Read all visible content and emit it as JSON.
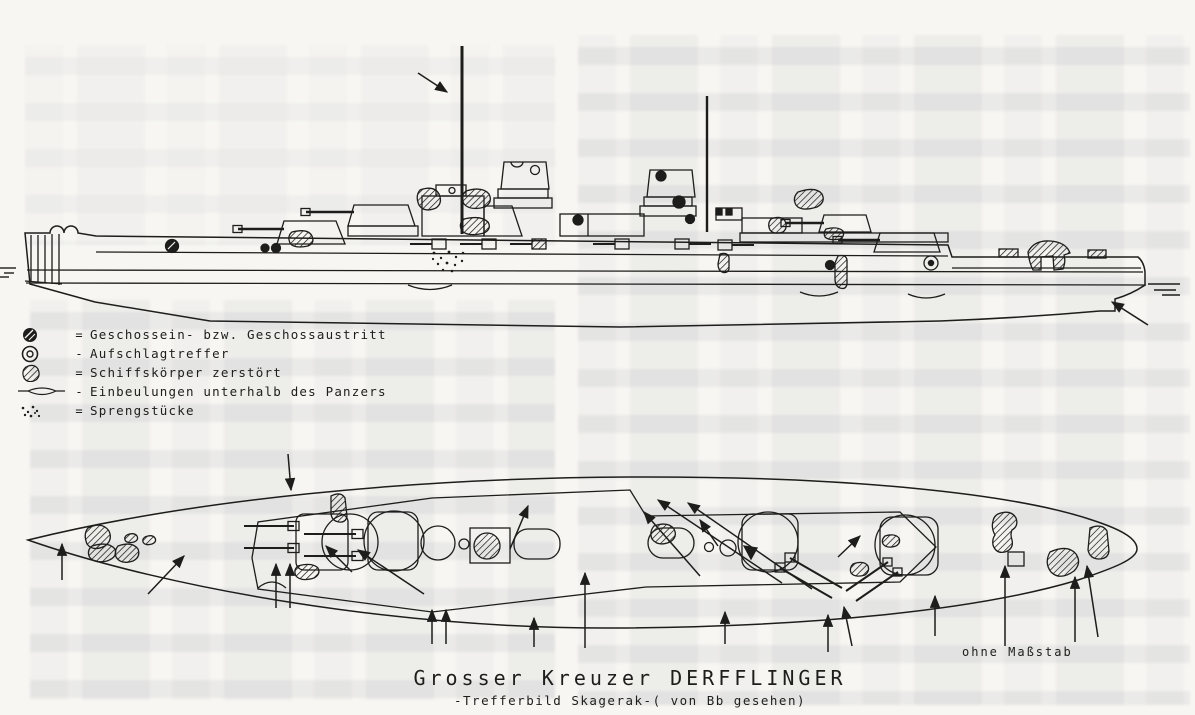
{
  "colors": {
    "ink": "#1d1d1b",
    "paper": "#f7f6f2"
  },
  "legend": {
    "items": [
      {
        "icon": "shell-entry-exit-symbol",
        "sep": "=",
        "label": "Geschossein- bzw. Geschossaustritt"
      },
      {
        "icon": "impact-hit-symbol",
        "sep": "-",
        "label": "Aufschlagtreffer"
      },
      {
        "icon": "hull-destroyed-symbol",
        "sep": "=",
        "label": "Schiffskörper zerstört"
      },
      {
        "icon": "dent-below-armor-symbol",
        "sep": "-",
        "label": "Einbeulungen unterhalb des Panzers"
      },
      {
        "icon": "shell-fragments-symbol",
        "sep": "=",
        "label": "Sprengstücke"
      }
    ]
  },
  "caption": {
    "title": "Grosser Kreuzer DERFFLINGER",
    "subtitle": "-Trefferbild Skagerak-( von Bb gesehen)"
  },
  "scale_note": "ohne Maßstab"
}
